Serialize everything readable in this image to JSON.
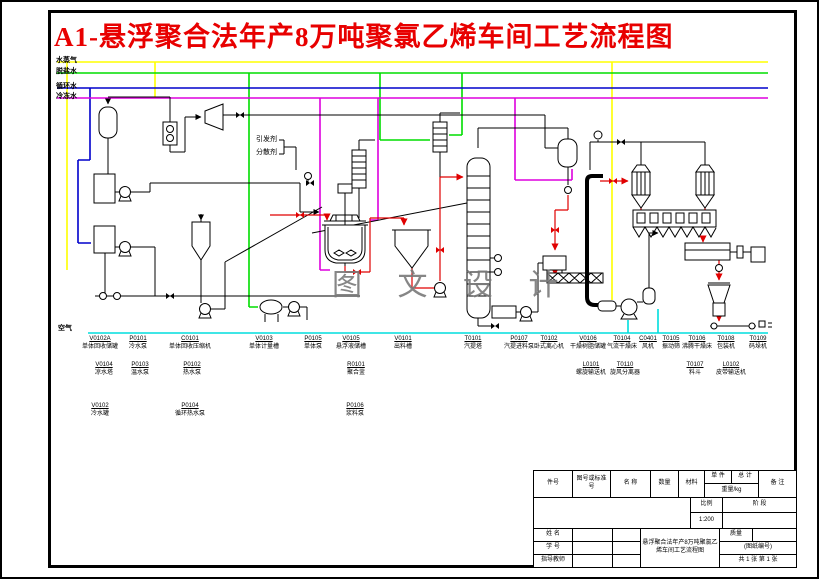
{
  "title": "A1-悬浮聚合法年产8万吨聚氯乙烯车间工艺流程图",
  "watermark": "图 文 设 计",
  "utilities": {
    "steam": "水蒸气",
    "desalted": "脱盐水",
    "circulating": "循环水",
    "chilled": "冷冻水",
    "air": "空气"
  },
  "reagents": {
    "initiator": "引发剂",
    "dispersant": "分散剂"
  },
  "colors": {
    "steam": "#ffff00",
    "desalted": "#00dd00",
    "circulating": "#0000cc",
    "chilled": "#dd00dd",
    "air": "#00dddd",
    "product_flow": "#e00000",
    "title": "#e80000"
  },
  "equipment_labels": {
    "row1": [
      {
        "tag": "V0102A",
        "name": "单体回收储罐"
      },
      {
        "tag": "P0101",
        "name": "冷水泵"
      },
      {
        "tag": "C0101",
        "name": "单体回收压缩机"
      },
      {
        "tag": "V0103",
        "name": "单体计量槽"
      },
      {
        "tag": "P0105",
        "name": "单体泵"
      },
      {
        "tag": "V0105",
        "name": "悬浮液储槽"
      },
      {
        "tag": "V0101",
        "name": "出料槽"
      },
      {
        "tag": "T0101",
        "name": "汽提塔"
      },
      {
        "tag": "P0107",
        "name": "汽提进料泵"
      },
      {
        "tag": "T0102",
        "name": "卧式离心机"
      },
      {
        "tag": "V0106",
        "name": "干燥树脂储罐"
      },
      {
        "tag": "T0104",
        "name": "气流干燥床"
      },
      {
        "tag": "C0401",
        "name": "风机"
      },
      {
        "tag": "T0105",
        "name": "振动筛"
      },
      {
        "tag": "T0106",
        "name": "沸腾干燥床"
      },
      {
        "tag": "T0108",
        "name": "包装机"
      },
      {
        "tag": "T0109",
        "name": "码垛机"
      }
    ],
    "row2": [
      {
        "tag": "V0104",
        "name": "凉水塔"
      },
      {
        "tag": "P0103",
        "name": "温水泵"
      },
      {
        "tag": "P0102",
        "name": "热水泵"
      },
      {
        "tag": "R0101",
        "name": "聚合釜"
      },
      {
        "tag": "L0101",
        "name": "螺旋输送机"
      },
      {
        "tag": "T0110",
        "name": "旋风分离器"
      },
      {
        "tag": "T0107",
        "name": "料斗"
      },
      {
        "tag": "L0102",
        "name": "皮带输送机"
      }
    ],
    "row3": [
      {
        "tag": "V0102",
        "name": "冷水罐"
      },
      {
        "tag": "P0104",
        "name": "循环热水泵"
      },
      {
        "tag": "P0106",
        "name": "浆料泵"
      }
    ]
  },
  "title_block": {
    "bom_headers": {
      "item_no": "件号",
      "std_no": "图号或标准号",
      "name": "名 称",
      "qty": "数量",
      "material": "材料",
      "unit": "单 件",
      "total": "总 计",
      "weight": "重量/kg",
      "remark": "备 注"
    },
    "scale_label": "比例",
    "scale_value": "1:200",
    "stage_label": "阶 段",
    "name_label": "姓 名",
    "student_no_label": "学 号",
    "advisor_label": "指导教师",
    "mass_label": "质量",
    "drawing_no_placeholder": "(图纸编号)",
    "sheet_info": "共 1 张  第 1 张",
    "drawing_title": "悬浮聚合法年产8万吨聚氯乙烯车间工艺流程图"
  }
}
